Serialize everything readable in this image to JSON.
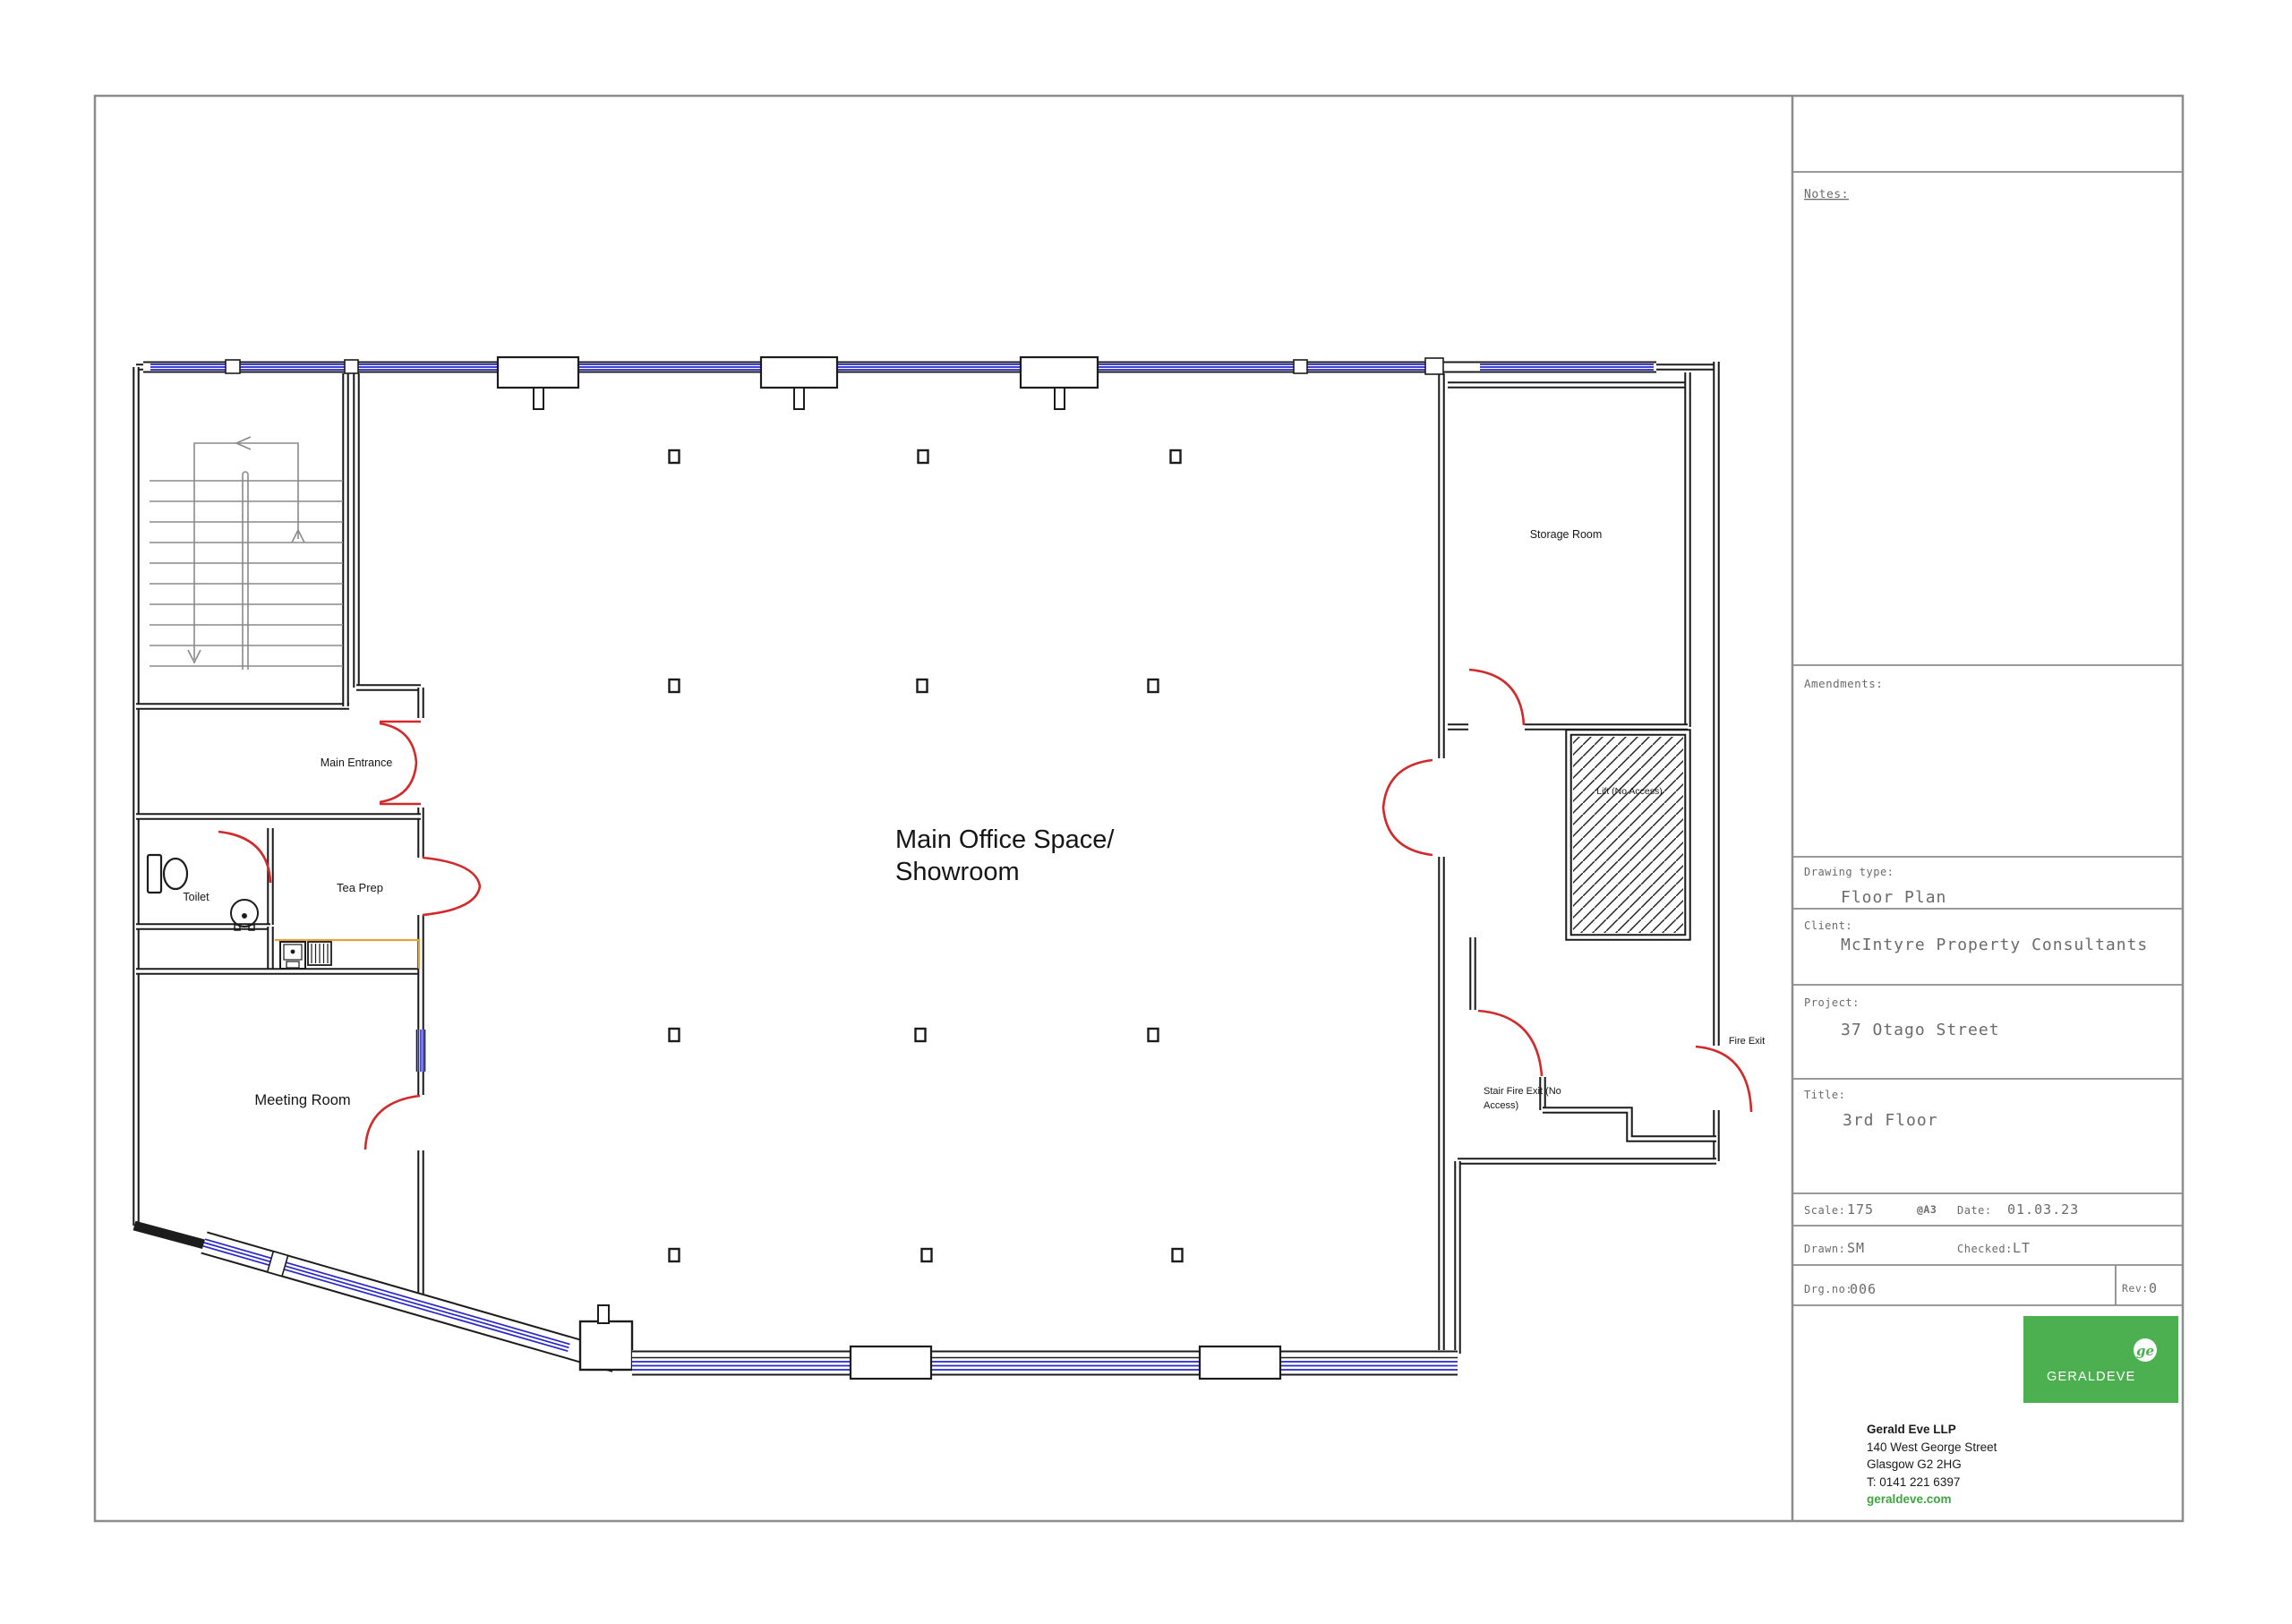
{
  "page": {
    "background": "#ffffff",
    "border_color": "#8c8c8c"
  },
  "floor_plan": {
    "rooms": {
      "main_office": {
        "label_line1": "Main Office Space/",
        "label_line2": "Showroom"
      },
      "meeting_room": {
        "label": "Meeting Room"
      },
      "toilet": {
        "label": "Toilet"
      },
      "tea_prep": {
        "label": "Tea Prep"
      },
      "storage_room": {
        "label": "Storage Room"
      },
      "lift": {
        "label": "Lift (No Access)"
      }
    },
    "doors": {
      "main_entrance": {
        "label": "Main Entrance"
      },
      "fire_exit": {
        "label": "Fire Exit"
      },
      "stair_fire_exit": {
        "label_line1": "Stair Fire Exit (No",
        "label_line2": "Access)"
      }
    },
    "colors": {
      "wall": "#1c1c1c",
      "window": "#2626cc",
      "door": "#d22a2a",
      "stair": "#8a8a8a",
      "counter": "#e8a23c"
    }
  },
  "title_block": {
    "notes_label": "Notes:",
    "amendments_label": "Amendments:",
    "drawing_type": {
      "label": "Drawing type:",
      "value": "Floor Plan"
    },
    "client": {
      "label": "Client:",
      "value": "McIntyre Property Consultants"
    },
    "project": {
      "label": "Project:",
      "value": "37 Otago Street"
    },
    "title": {
      "label": "Title:",
      "value": "3rd Floor"
    },
    "scale": {
      "label": "Scale:",
      "value": "175"
    },
    "paper": "@A3",
    "date": {
      "label": "Date:",
      "value": "01.03.23"
    },
    "drawn": {
      "label": "Drawn:",
      "value": "SM"
    },
    "checked": {
      "label": "Checked:",
      "value": "LT"
    },
    "drg_no": {
      "label": "Drg.no:",
      "value": "006"
    },
    "rev": {
      "label": "Rev:",
      "value": "0"
    },
    "logo": {
      "text": "GERALDEVE",
      "monogram": "ge",
      "color": "#4CB050"
    },
    "firm": {
      "name": "Gerald Eve LLP",
      "address_line1": "140 West George Street",
      "address_line2": "Glasgow G2 2HG",
      "phone": "T: 0141 221 6397",
      "website": "geraldeve.com"
    }
  }
}
